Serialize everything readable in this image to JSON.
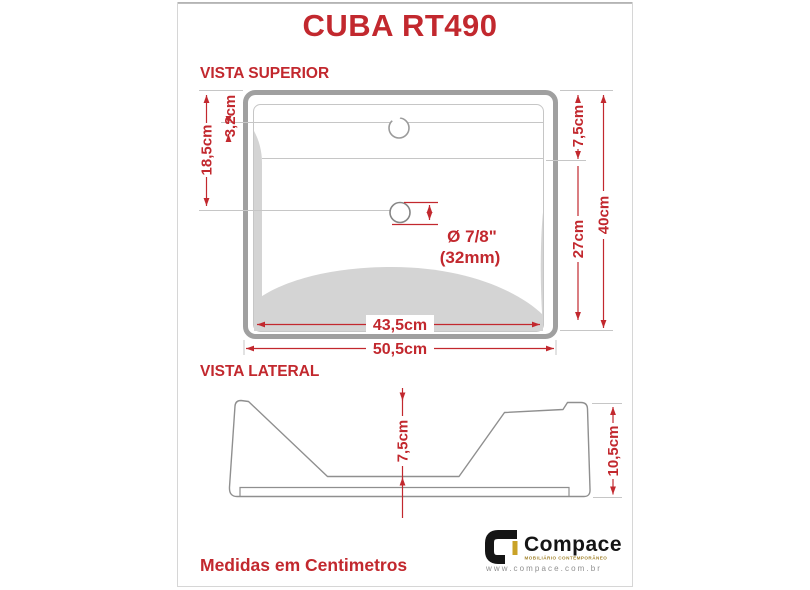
{
  "title": "CUBA RT490",
  "top_view": {
    "label": "VISTA SUPERIOR",
    "dim_18_5": "18,5cm",
    "dim_3_2": "3,2cm",
    "dim_7_5": "7,5cm",
    "dim_27": "27cm",
    "dim_40": "40cm",
    "dim_43_5": "43,5cm",
    "dim_50_5": "50,5cm",
    "drain_d_inch": "Ø 7/8\"",
    "drain_d_mm": "(32mm)"
  },
  "side_view": {
    "label": "VISTA LATERAL",
    "dim_7_5": "7,5cm",
    "dim_10_5": "10,5cm"
  },
  "footer_note": "Medidas em Centimetros",
  "brand": {
    "name": "Compace",
    "tagline": "MOBILIÁRIO CONTEMPORÂNEO",
    "website": "www.compace.com.br"
  },
  "colors": {
    "accent_red": "#c2282e",
    "outline_gray": "#a0a0a0",
    "detail_gray": "#c6c6c6",
    "fill_gray": "#d4d4d4",
    "brand_black": "#151515",
    "brand_gold": "#c9a227"
  }
}
